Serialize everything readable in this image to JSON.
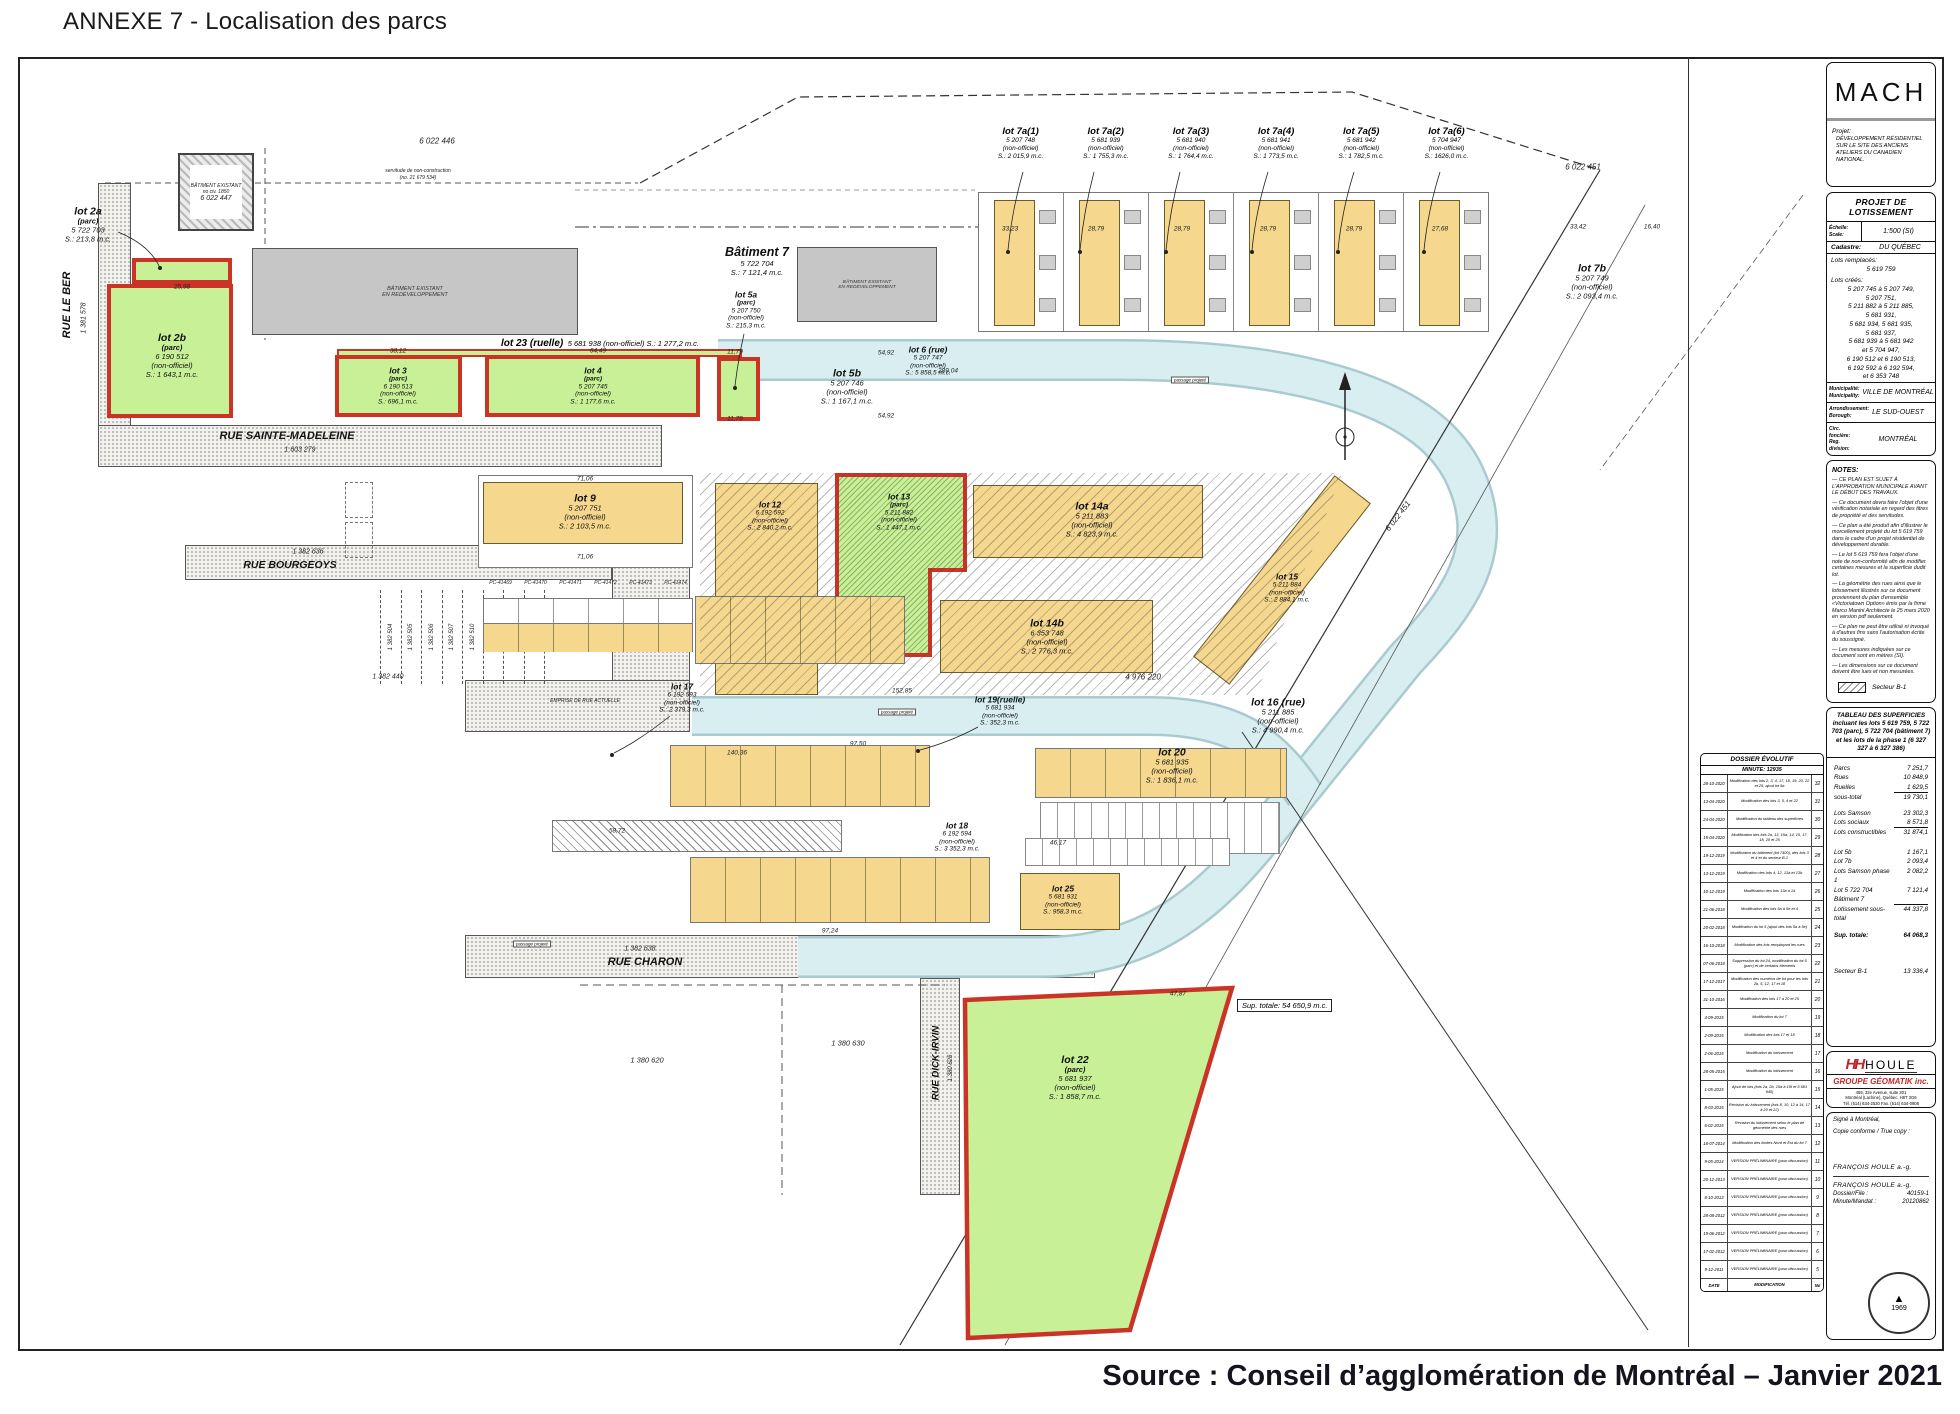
{
  "page": {
    "title": "ANNEXE 7 - Localisation des parcs",
    "source": "Source : Conseil d’agglomération de Montréal – Janvier 2021"
  },
  "lots": {
    "lot2a": {
      "l1": "lot 2a",
      "l2": "(parc)",
      "l3": "5 722 703",
      "l4": "S.: 213,8 m.c."
    },
    "lot2b": {
      "l1": "lot 2b",
      "l2": "(parc)",
      "l3": "6 190 512",
      "l4": "(non-officiel)",
      "l5": "S.: 1 643,1 m.c."
    },
    "lot3": {
      "l1": "lot 3",
      "l2": "(parc)",
      "l3": "6 190 513",
      "l4": "(non-officiel)",
      "l5": "S.: 696,1 m.c."
    },
    "lot4": {
      "l1": "lot 4",
      "l2": "(parc)",
      "l3": "5 207 745",
      "l4": "(non-officiel)",
      "l5": "S.: 1 177,6 m.c."
    },
    "lot23": {
      "l1": "lot 23 (ruelle)",
      "l2": "5 681 938 (non-officiel)  S.: 1 277,2 m.c."
    },
    "lot5a": {
      "l1": "lot 5a",
      "l2": "(parc)",
      "l3": "5 207 750",
      "l4": "(non-officiel)",
      "l5": "S.: 215,3 m.c."
    },
    "lot5b": {
      "l1": "lot 5b",
      "l2": "5 207 746",
      "l3": "(non-officiel)",
      "l4": "S.: 1 167,1 m.c."
    },
    "bat7": {
      "l1": "Bâtiment 7",
      "l2": "5 722 704",
      "l3": "S.: 7 121,4 m.c."
    },
    "lot6": {
      "l1": "lot 6 (rue)",
      "l2": "5 207 747",
      "l3": "(non-officiel)",
      "l4": "S.: 5 858,5 m.c."
    },
    "lot7a1": {
      "l1": "lot 7a(1)",
      "l2": "5 207 748",
      "l3": "(non-officiel)",
      "l4": "S.: 2 015,9 m.c."
    },
    "lot7a2": {
      "l1": "lot 7a(2)",
      "l2": "5 681 939",
      "l3": "(non-officiel)",
      "l4": "S.: 1 755,3 m.c."
    },
    "lot7a3": {
      "l1": "lot 7a(3)",
      "l2": "5 681 940",
      "l3": "(non-officiel)",
      "l4": "S.: 1 764,4 m.c."
    },
    "lot7a4": {
      "l1": "lot 7a(4)",
      "l2": "5 681 941",
      "l3": "(non-officiel)",
      "l4": "S.: 1 773,5 m.c."
    },
    "lot7a5": {
      "l1": "lot 7a(5)",
      "l2": "5 681 942",
      "l3": "(non-officiel)",
      "l4": "S.: 1 782,5 m.c."
    },
    "lot7a6": {
      "l1": "lot 7a(6)",
      "l2": "5 704 947",
      "l3": "(non-officiel)",
      "l4": "S.: 1626,0 m.c."
    },
    "lot7b": {
      "l1": "lot 7b",
      "l2": "5 207 749",
      "l3": "(non-officiel)",
      "l4": "S.: 2 093,4 m.c."
    },
    "lot9": {
      "l1": "lot 9",
      "l2": "5 207 751",
      "l3": "(non-officiel)",
      "l4": "S.: 2 103,5 m.c."
    },
    "lot12": {
      "l1": "lot 12",
      "l2": "6 192 592",
      "l3": "(non-officiel)",
      "l4": "S.: 2 840,2 m.c."
    },
    "lot13": {
      "l1": "lot 13",
      "l2": "(parc)",
      "l3": "5 211 882",
      "l4": "(non-officiel)",
      "l5": "S.: 1 447,1 m.c."
    },
    "lot14a": {
      "l1": "lot 14a",
      "l2": "5 211 883",
      "l3": "(non-officiel)",
      "l4": "S.: 4 823,9 m.c."
    },
    "lot14b": {
      "l1": "lot 14b",
      "l2": "6 353 748",
      "l3": "(non-officiel)",
      "l4": "S.: 2 776,3 m.c."
    },
    "lot15": {
      "l1": "lot 15",
      "l2": "5 211 884",
      "l3": "(non-officiel)",
      "l4": "S.: 2 884,1 m.c."
    },
    "lot16": {
      "l1": "lot 16 (rue)",
      "l2": "5 211 885",
      "l3": "(non-officiel)",
      "l4": "S.: 4 990,4 m.c."
    },
    "lot17": {
      "l1": "lot 17",
      "l2": "6 192 593",
      "l3": "(non-officiel)",
      "l4": "S.: 2 379,3 m.c."
    },
    "lot18": {
      "l1": "lot 18",
      "l2": "6 192 594",
      "l3": "(non-officiel)",
      "l4": "S.: 3 352,3 m.c."
    },
    "lot19": {
      "l1": "lot 19(ruelle)",
      "l2": "5 681 934",
      "l3": "(non-officiel)",
      "l4": "S.: 352,3 m.c."
    },
    "lot20": {
      "l1": "lot 20",
      "l2": "5 681 935",
      "l3": "(non-officiel)",
      "l4": "S.: 1 836,1 m.c."
    },
    "lot22": {
      "l1": "lot 22",
      "l2": "(parc)",
      "l3": "5 681 937",
      "l4": "(non-officiel)",
      "l5": "S.: 1 858,7 m.c."
    },
    "lot25": {
      "l1": "lot 25",
      "l2": "5 681 931",
      "l3": "(non-officiel)",
      "l4": "S.: 958,3 m.c."
    }
  },
  "streets": {
    "leber": "RUE LE BER",
    "stem": "RUE SAINTE-MADELEINE",
    "bourg": "RUE BOURGEOYS",
    "charon": "RUE CHARON",
    "dick": "RUE DICK-IRVIN",
    "emprise": "EMPRISE DE RUE ACTUELLE"
  },
  "cads": {
    "c446": "6 022 446",
    "c447": "6 022 447",
    "c451": "6 022 451",
    "c451b": "6 022 451",
    "c4976": "4 976 220",
    "c620": "1 380 620",
    "c630": "1 380 630",
    "c626": "1 380 626",
    "c440": "1 382 440",
    "leber": "1 381 578",
    "stem": "1 603 279",
    "bourg": "1 382 636",
    "charon": "1 382 638"
  },
  "ann": {
    "serv1": "servitude de non-construction",
    "serv2": "(no. 21 679 534)",
    "bat1": "BÂTIMENT EXISTANT",
    "bat2": "EN REDÉVELOPPEMENT",
    "civ": "no civ. 1850",
    "sup": "Sup. totale: 54 650,9 m.c.",
    "passage": "passage projeté"
  },
  "dims": [
    "289,04",
    "54,92",
    "54,92",
    "71,06",
    "71,06",
    "64,49",
    "38,12",
    "25,98",
    "33,23",
    "28,79",
    "28,79",
    "28,79",
    "28,79",
    "27,68",
    "33,42",
    "16,40",
    "97,50",
    "140,36",
    "152,85",
    "97,24",
    "58,72",
    "46,17",
    "47,87",
    "11,79",
    "11,79"
  ],
  "pc": [
    "PC-41469",
    "PC-41470",
    "PC-41471",
    "PC-41472",
    "PC-41473",
    "PC-41474"
  ],
  "strips": [
    "1 382 504",
    "1 382 505",
    "1 382 506",
    "1 382 507",
    "1 382 510",
    "1 382 511",
    "1 382 512",
    "1 382 513"
  ],
  "sidebar": {
    "logo": "MACH",
    "projet_label": "Projet:",
    "projet": "DÉVELOPPEMENT RÉSIDENTIEL SUR LE SITE DES ANCIENS ATELIERS DU CANADIEN NATIONAL.",
    "lot_title": "PROJET DE LOTISSEMENT",
    "scale_l1": "Échelle:",
    "scale_l2": "Scale:",
    "scale_v": "1:500 (SI)",
    "cad_l": "Cadastre:",
    "cad_v": "DU QUÉBEC",
    "rempl_l": "Lots remplacés:",
    "rempl_v": "5 619 759",
    "crees_l": "Lots créés:",
    "crees": [
      "5 207 745 à 5 207 749,",
      "5 207 751,",
      "5 211 882 à 5 211 885,",
      "5 681 931,",
      "5 681 934, 5 681 935,",
      "5 681 937,",
      "5 681 939 à 5 681 942",
      "et 5 704 947,",
      "6 190 512 et 6 190 513,",
      "6 192 592 à 6 192 594,",
      "et 6 353 748"
    ],
    "mun_l1": "Municipalité:",
    "mun_l2": "Municipality:",
    "mun_v": "VILLE DE MONTRÉAL",
    "arr_l1": "Arrondissement:",
    "arr_l2": "Borough:",
    "arr_v": "LE SUD-OUEST",
    "circ_l1": "Circ. foncière:",
    "circ_l2": "Reg. division:",
    "circ_v": "MONTRÉAL",
    "notes_title": "NOTES:",
    "notes": [
      "— CE PLAN EST SUJET À L'APPROBATION MUNICIPALE AVANT LE DÉBUT DES TRAVAUX.",
      "— Ce document devra faire l'objet d'une vérification notariale en regard des titres de propriété et des servitudes.",
      "— Ce plan a été produit afin d'illustrer le morcellement projeté du lot 5 619 759 dans le cadre d'un projet résidentiel de développement durable.",
      "— Le lot 5 619 759 fera l'objet d'une note de non-conformité afin de modifier certaines mesures et la superficie dudit lot.",
      "— La géométrie des rues ainsi que le lotissement illustrés sur ce document proviennent du plan d'ensemble «Victoriatown Option» émis par la firme Marco Manini Architecte le 25 mars 2020 en version pdf seulement.",
      "— Ce plan ne peut être utilisé ni invoqué à d'autres fins sans l'autorisation écrite du soussigné.",
      "— Les mesures indiquées sur ce document sont en mètres (SI).",
      "— Les dimensions sur ce document doivent être lues et non mesurées."
    ],
    "secteur": "Secteur B-1",
    "tbl_title": "TABLEAU DES SUPERFICIES incluant les lots 5 619 759, 5 722 703 (parc), 5 722 704 (bâtiment 7) et les lots de la phase 1 (6 327 327 à 6 327 386)",
    "tbl": [
      {
        "label": "Parcs",
        "value": "7 251,7"
      },
      {
        "label": "Rues",
        "value": "10 848,9"
      },
      {
        "label": "Ruelles",
        "value": "1 629,5"
      },
      {
        "label": "sous-total",
        "value": "19 730,1"
      },
      {
        "label": "Lots Samson",
        "value": "23 302,3"
      },
      {
        "label": "Lots sociaux",
        "value": "8 571,8"
      },
      {
        "label": "Lots constructibles",
        "value": "31 874,1"
      },
      {
        "label": "Lot 5b",
        "value": "1 167,1"
      },
      {
        "label": "Lot 7b",
        "value": "2 093,4"
      },
      {
        "label": "Lots Samson phase 1",
        "value": "2 082,2"
      },
      {
        "label": "Lot 5 722 704 Bâtiment 7",
        "value": "7 121,4"
      },
      {
        "label": "Lotissement sous-total",
        "value": "44 337,8"
      },
      {
        "label": "Sup. totale:",
        "value": "64 068,3"
      },
      {
        "label": "Secteur B-1",
        "value": "13 336,4"
      }
    ],
    "houle_hh": "HH",
    "houle": "HOULE",
    "geo": "GROUPE GÉOMATIK inc.",
    "addr": [
      "455, 32e Avenue, suite 201",
      "Montréal (Lachine), Québec, H8T 3G6",
      "Tél. (514) 634-2530   Fax. (514) 634-0908"
    ],
    "sig1": "Signé à Montréal,",
    "sig2": "Copie conforme / True copy :",
    "name1": "FRANÇOIS HOULE  a.-g.",
    "name2": "FRANÇOIS HOULE  a.-g.",
    "dossier_l": "Dossier/File :",
    "dossier_v": "40159-1",
    "minute_l": "Minute/Mandat :",
    "minute_v": "20120862",
    "seal": "1969"
  },
  "dossier": {
    "title": "DOSSIER ÉVOLUTIF",
    "minute": "MINUTE: 12935",
    "f_date": "DATE",
    "f_mod": "MODIFICATION",
    "f_no": "No",
    "rows": [
      {
        "d": "28-10-2020",
        "m": "Modification des lots 2, 3, 4, 17, 18, 19, 20, 22 et 25; ajout lot 5a",
        "n": "32"
      },
      {
        "d": "13-04-2020",
        "m": "Modification des lots 3, 5, 4 et 22",
        "n": "31"
      },
      {
        "d": "24-04-2020",
        "m": "Modification du tableau des superficies",
        "n": "30"
      },
      {
        "d": "15-04-2020",
        "m": "Modification des lots 2a, 13, 15a, 14, 15, 17, 18, 20 et 25",
        "n": "29"
      },
      {
        "d": "19-12-2019",
        "m": "Modification du bâtiment (lot 7400), des lots 3 et 4 et du secteur B-1",
        "n": "28"
      },
      {
        "d": "13-12-2019",
        "m": "Modification des lots 4, 12, 13a et 13b",
        "n": "27"
      },
      {
        "d": "10-12-2019",
        "m": "Modification des lots 13a à 14",
        "n": "26"
      },
      {
        "d": "21-06-2018",
        "m": "Modification des lots 5a à 5e et 4",
        "n": "25"
      },
      {
        "d": "20-02-2018",
        "m": "Modification du lot 5 (ajout des lots 5a à 5e)",
        "n": "24"
      },
      {
        "d": "16-10-2018",
        "m": "Modification des lots remplaçant les rues",
        "n": "23"
      },
      {
        "d": "07-06-2018",
        "m": "Suppression du lot 24, modification du lot 5 (parc) et de certains éléments",
        "n": "22"
      },
      {
        "d": "17-12-2017",
        "m": "Modification des numéros de lot pour les lots 2b, 5, 12, 17 et 18",
        "n": "21"
      },
      {
        "d": "31-10-2016",
        "m": "Modification des lots 17 à 20 et 25",
        "n": "20"
      },
      {
        "d": "4-09-2015",
        "m": "Modification du lot 7",
        "n": "19"
      },
      {
        "d": "2-09-2015",
        "m": "Modification des lots 17 et 18",
        "n": "18"
      },
      {
        "d": "2-06-2015",
        "m": "Modification du lotissement",
        "n": "17"
      },
      {
        "d": "28-05-2015",
        "m": "Modification du lotissement",
        "n": "16"
      },
      {
        "d": "1-05-2015",
        "m": "Ajout de lots (lots 2a, 2b, 15a à 15f et 5 681 940)",
        "n": "15"
      },
      {
        "d": "8-03-2015",
        "m": "Révision du lotissement (lots 8, 10, 12 à 14, 17 à 20 et 22)",
        "n": "14"
      },
      {
        "d": "6-02-2015",
        "m": "Révision du lotissement selon le plan de géométrie des rues",
        "n": "13"
      },
      {
        "d": "18-07-2014",
        "m": "Modification des limites Nord et Est du lot 7",
        "n": "12"
      },
      {
        "d": "9-05-2014",
        "m": "VERSION PRÉLIMINAIRE (pour discussion)",
        "n": "11"
      },
      {
        "d": "20-12-2013",
        "m": "VERSION PRÉLIMINAIRE (pour discussion)",
        "n": "10"
      },
      {
        "d": "8-10-2013",
        "m": "VERSION PRÉLIMINAIRE (pour discussion)",
        "n": "9"
      },
      {
        "d": "28-08-2012",
        "m": "VERSION PRÉLIMINAIRE (pour discussion)",
        "n": "8"
      },
      {
        "d": "19-06-2012",
        "m": "VERSION PRÉLIMINAIRE (pour discussion)",
        "n": "7"
      },
      {
        "d": "17-02-2012",
        "m": "VERSION PRÉLIMINAIRE (pour discussion)",
        "n": "6"
      },
      {
        "d": "9-12-2011",
        "m": "VERSION PRÉLIMINAIRE (pour discussion)",
        "n": "5"
      }
    ]
  }
}
